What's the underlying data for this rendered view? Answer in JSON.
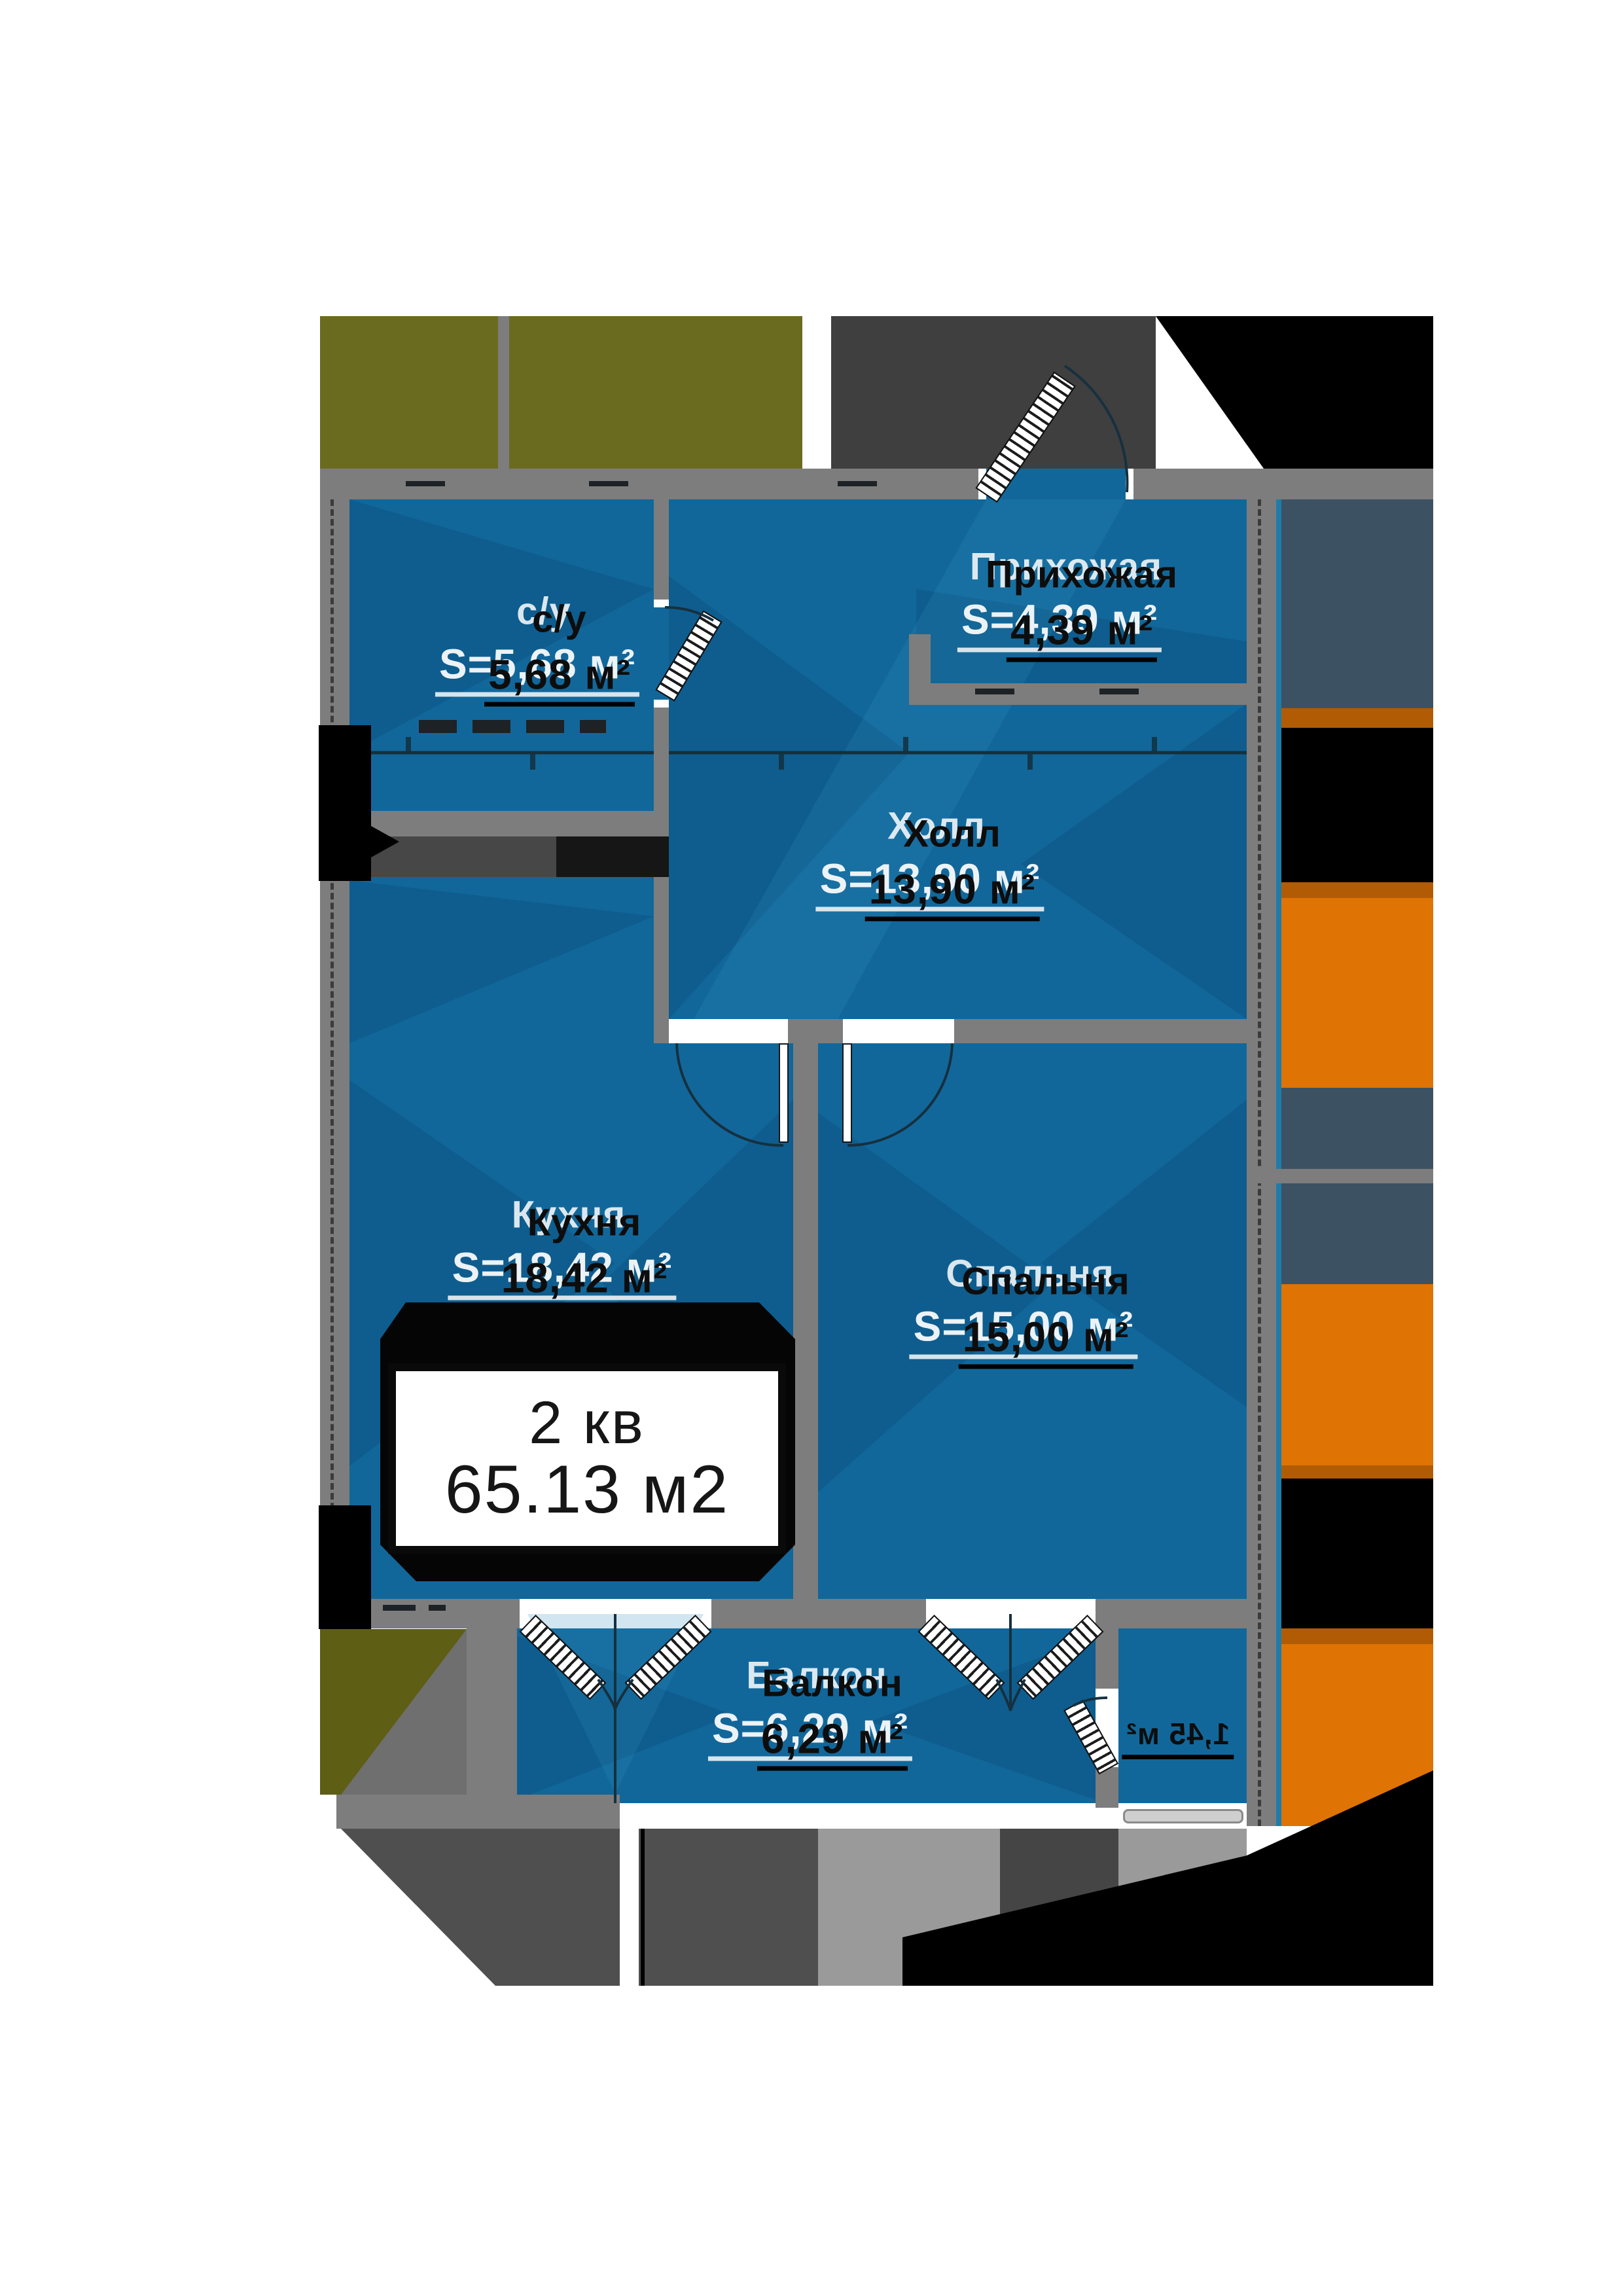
{
  "plan": {
    "type": "apartment-floor-plan",
    "apartment": {
      "number_label": "2 кв",
      "total_area_label": "65.13 м2"
    },
    "rooms": [
      {
        "id": "bathroom",
        "name": "с/у",
        "area": "5,68 м²",
        "ghost": "S=5,68 м²"
      },
      {
        "id": "hallway",
        "name": "Прихожая",
        "area": "4,39 м²",
        "ghost": "S=4,39 м²"
      },
      {
        "id": "hall",
        "name": "Холл",
        "area": "13,90 м²",
        "ghost": "S=13,90 м²"
      },
      {
        "id": "kitchen",
        "name": "Кухня",
        "area": "18,42 м²",
        "ghost": "S=18,42 м²"
      },
      {
        "id": "bedroom",
        "name": "Спальня",
        "area": "15,00 м²",
        "ghost": "S=15,00 м²"
      },
      {
        "id": "balcony",
        "name": "Балкон",
        "area": "6,29 м²",
        "ghost": "S=6,29 м²"
      },
      {
        "id": "balcony-small",
        "name": "",
        "area": "1,45 м²",
        "ghost": ""
      }
    ],
    "colors": {
      "room_fill": "#12679a",
      "room_shade": "#084e7c",
      "wall": "#7d7d7d",
      "context_olive": "#6b6b1f",
      "context_dark_gray": "#3f3f3f",
      "context_slate": "#3c5263",
      "context_orange": "#df7303",
      "context_black": "#000000",
      "info_box_bg": "#ffffff",
      "info_text": "#161616",
      "label_text": "#0d0d0d",
      "label_ghost": "#ffffff"
    }
  }
}
